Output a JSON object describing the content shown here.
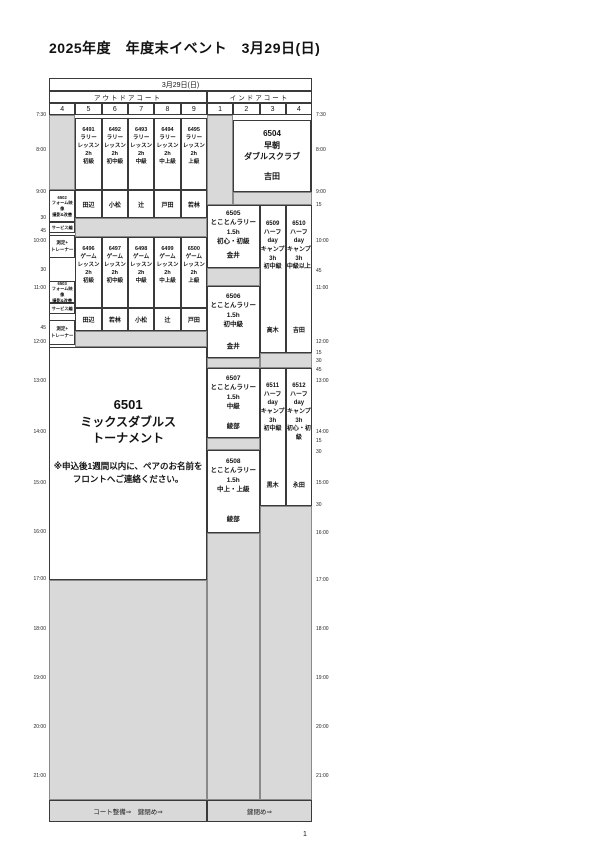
{
  "page": {
    "title": "2025年度　年度末イベント　3月29日(日)",
    "page_number": "1"
  },
  "header": {
    "date": "3月29日(日)",
    "outdoor_label": "アウトドアコート",
    "indoor_label": "インドアコート",
    "outdoor_courts": [
      "4",
      "5",
      "6",
      "7",
      "8",
      "9"
    ],
    "indoor_courts": [
      "1",
      "2",
      "3",
      "4"
    ]
  },
  "time_axis": {
    "left": [
      "7:30",
      "8:00",
      "9:00",
      "30",
      "45",
      "10:00",
      "30",
      "11:00",
      "45",
      "12:00",
      "13:00",
      "14:00",
      "15:00",
      "16:00",
      "17:00",
      "18:00",
      "19:00",
      "20:00",
      "21:00"
    ],
    "right": [
      "7:30",
      "8:00",
      "9:00",
      "15",
      "10:00",
      "45",
      "11:00",
      "12:00",
      "15",
      "30",
      "45",
      "13:00",
      "14:00",
      "15",
      "30",
      "15:00",
      "30",
      "16:00",
      "17:00",
      "18:00",
      "19:00",
      "20:00",
      "21:00"
    ]
  },
  "footer": {
    "outdoor": "コート整備⇒　鍵閉め⇒",
    "indoor": "鍵閉め⇒"
  },
  "events": {
    "blocks": [
      {
        "id": "6491",
        "lines": [
          "6491",
          "ラリー",
          "レッスン",
          "2h",
          "初級"
        ],
        "instructor": "田辺"
      },
      {
        "id": "6492",
        "lines": [
          "6492",
          "ラリー",
          "レッスン",
          "2h",
          "初中級"
        ],
        "instructor": "小松"
      },
      {
        "id": "6493",
        "lines": [
          "6493",
          "ラリー",
          "レッスン",
          "2h",
          "中級"
        ],
        "instructor": "辻"
      },
      {
        "id": "6494",
        "lines": [
          "6494",
          "ラリー",
          "レッスン",
          "2h",
          "中上級"
        ],
        "instructor": "戸田"
      },
      {
        "id": "6495",
        "lines": [
          "6495",
          "ラリー",
          "レッスン",
          "2h",
          "上級"
        ],
        "instructor": "若林"
      },
      {
        "id": "6496",
        "lines": [
          "6496",
          "ゲーム",
          "レッスン",
          "2h",
          "初級"
        ],
        "instructor": "田辺"
      },
      {
        "id": "6497",
        "lines": [
          "6497",
          "ゲーム",
          "レッスン",
          "2h",
          "初中級"
        ],
        "instructor": "若林"
      },
      {
        "id": "6498",
        "lines": [
          "6498",
          "ゲーム",
          "レッスン",
          "2h",
          "中級"
        ],
        "instructor": "小松"
      },
      {
        "id": "6499",
        "lines": [
          "6499",
          "ゲーム",
          "レッスン",
          "2h",
          "中上級"
        ],
        "instructor": "辻"
      },
      {
        "id": "6500",
        "lines": [
          "6500",
          "ゲーム",
          "レッスン",
          "2h",
          "上級"
        ],
        "instructor": "戸田"
      },
      {
        "id": "c4a",
        "lines": [
          "6502",
          "フォーム映像",
          "撮影&改善"
        ]
      },
      {
        "id": "c4b",
        "lines": [
          "サービス編"
        ]
      },
      {
        "id": "c4c",
        "lines": [
          "測定+",
          "トレーナー"
        ]
      },
      {
        "id": "c4d",
        "lines": [
          "6503",
          "フォーム映像",
          "撮影&改善"
        ]
      },
      {
        "id": "c4e",
        "lines": [
          "サービス編"
        ]
      },
      {
        "id": "c4f",
        "lines": [
          "測定+",
          "トレーナー"
        ]
      },
      {
        "id": "6504",
        "lines": [
          "6504",
          "早朝",
          "ダブルスクラブ"
        ],
        "instructor": "吉田"
      },
      {
        "id": "6505",
        "lines": [
          "6505",
          "とことんラリー",
          "1.5h",
          "初心・初級"
        ],
        "instructor": "金井"
      },
      {
        "id": "6506",
        "lines": [
          "6506",
          "とことんラリー",
          "1.5h",
          "初中級"
        ],
        "instructor": "金井"
      },
      {
        "id": "6507",
        "lines": [
          "6507",
          "とことんラリー",
          "1.5h",
          "中級"
        ],
        "instructor": "綾部"
      },
      {
        "id": "6508",
        "lines": [
          "6508",
          "とことんラリー",
          "1.5h",
          "中上・上級"
        ],
        "instructor": "綾部"
      },
      {
        "id": "6509",
        "lines": [
          "6509",
          "ハーフ",
          "day",
          "キャンプ",
          "3h",
          "初中級"
        ],
        "instructor": "高木"
      },
      {
        "id": "6510",
        "lines": [
          "6510",
          "ハーフ",
          "day",
          "キャンプ",
          "3h",
          "中級以上"
        ],
        "instructor": "吉田"
      },
      {
        "id": "6511",
        "lines": [
          "6511",
          "ハーフ",
          "day",
          "キャンプ",
          "3h",
          "初中級"
        ],
        "instructor": "黒木"
      },
      {
        "id": "6512",
        "lines": [
          "6512",
          "ハーフ",
          "day",
          "キャンプ",
          "3h",
          "初心・初級"
        ],
        "instructor": "永田"
      },
      {
        "id": "6501",
        "lines": [
          "6501",
          "ミックスダブルス",
          "トーナメント"
        ],
        "note": [
          "※申込後1週間以内に、ペアのお名前を",
          "フロントへご連絡ください。"
        ]
      }
    ]
  }
}
